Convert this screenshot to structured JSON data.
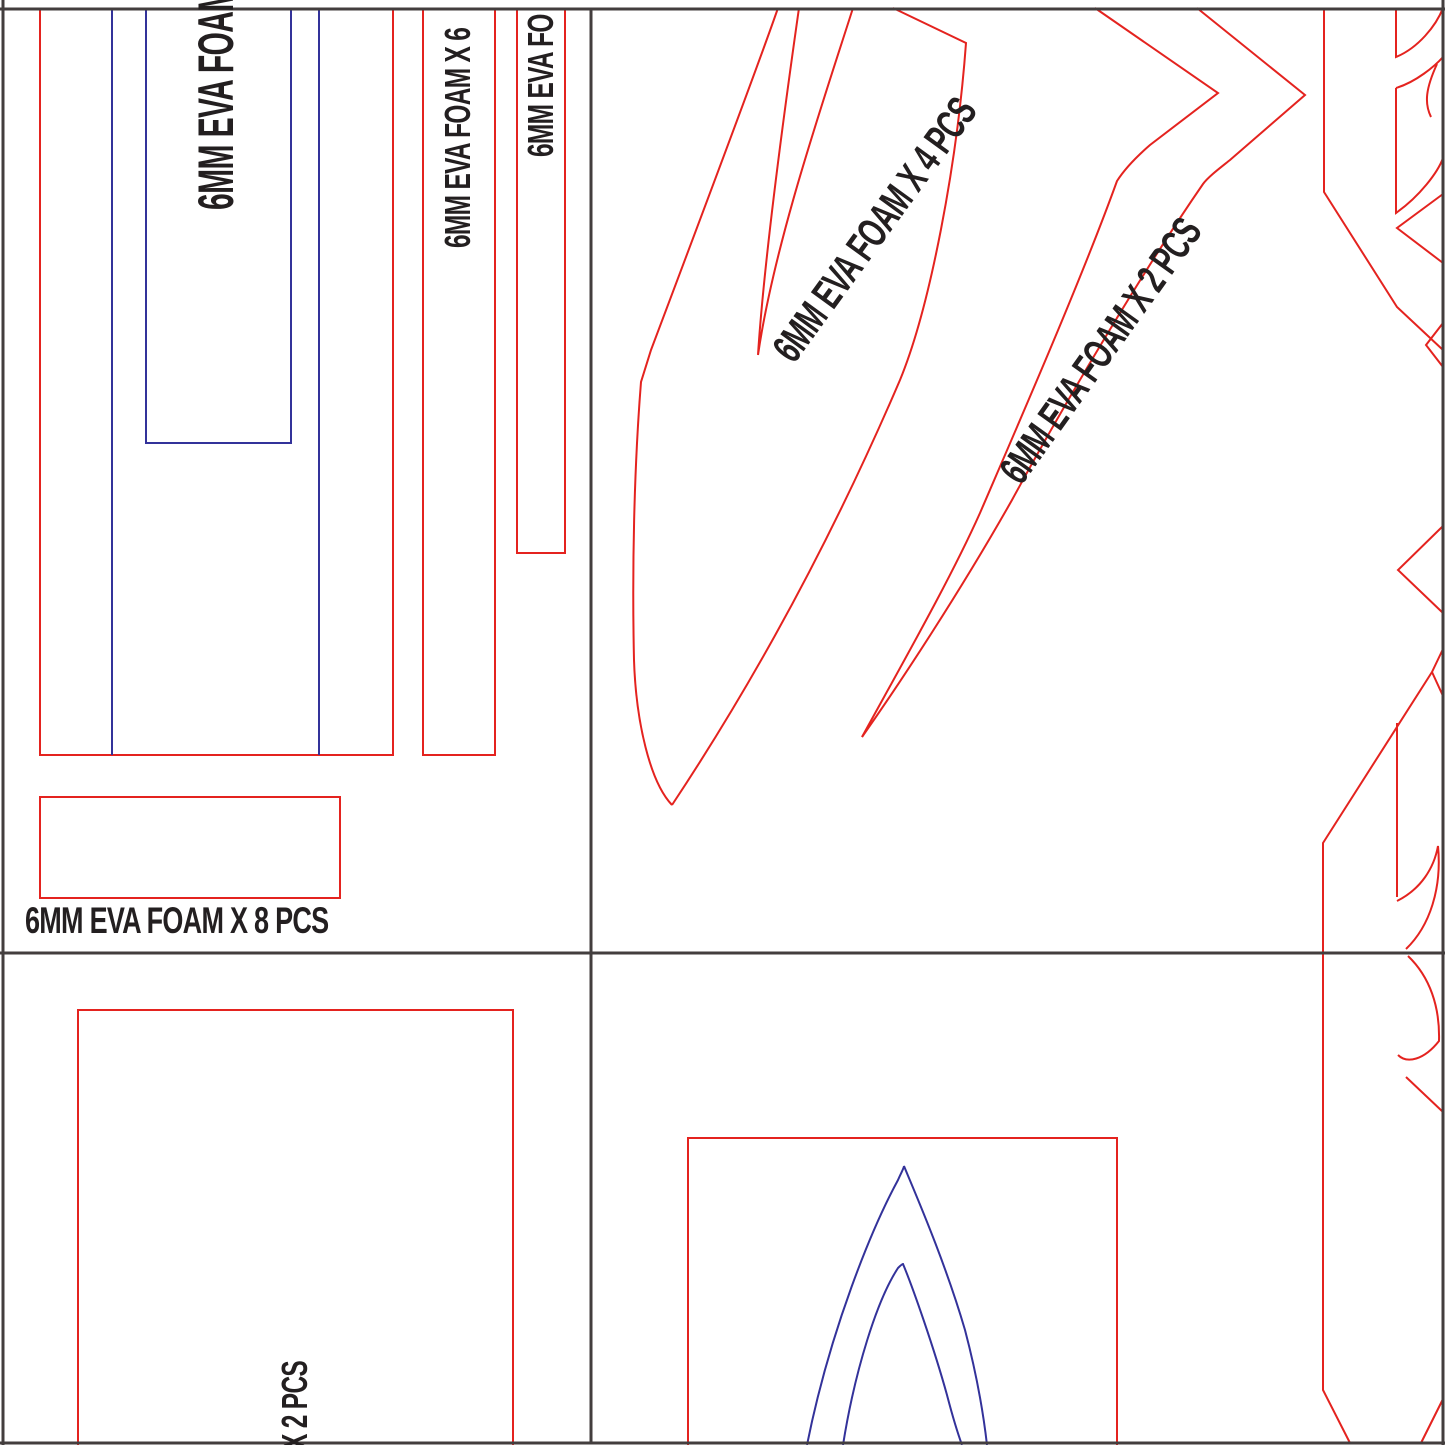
{
  "title": "EVA foam pattern sheet",
  "colors": {
    "red": "#e4231f",
    "blue": "#33329a",
    "ink": "#231f20",
    "border": "#433e3e",
    "paper": "#ffffff"
  },
  "labels": {
    "tall_strip": "6MM EVA FOAM",
    "strip_x6": "6MM EVA FOAM X 6",
    "strip_fo": "6MM EVA FO",
    "sheet1_total": "6MM EVA FOAM X 8 PCS",
    "band_x4": "6MM EVA FOAM  X 4 PCS",
    "band_x2": "6MM EVA FOAM  X 2 PCS",
    "sheet3_partial": "X 2 PCS"
  }
}
